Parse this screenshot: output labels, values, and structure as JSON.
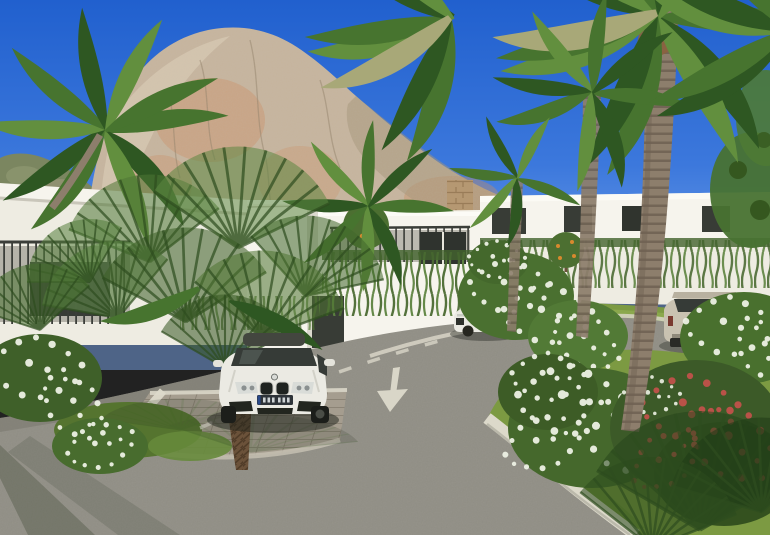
{
  "image_meta": {
    "kind": "photorealistic 3D architectural rendering",
    "subject": "modern white villa development at the foot of a large limestone rock, palm garden, curving asphalt road, white coupe parked on paver driveway",
    "contains_readable_text": false
  },
  "palette": {
    "sky_top": "#2160ce",
    "sky_mid": "#3c78dc",
    "sky_bottom": "#79a6ec",
    "rock_base": "#c6b49d",
    "rock_light": "#ddcfb8",
    "rock_orange": "#cb9168",
    "rock_shadow": "#a39378",
    "hill_green": "#7b8660",
    "building_white": "#f6f4ed",
    "building_face": "#eeece2",
    "building_shade": "#dcd9cf",
    "railing_dark": "#3b3e39",
    "window_dark": "#383c36",
    "vine_green": "#4c6b33",
    "grass_bright": "#7c9a42",
    "grass_dark": "#55742f",
    "frond_dark": "#2e5722",
    "frond_mid": "#47742f",
    "frond_light": "#628f3e",
    "trunk_brown": "#8d7e6c",
    "trunk_fiber": "#6b523a",
    "road_gray": "#8f8d84",
    "paver_tan": "#a59d8f",
    "line_white": "#d9d6c8",
    "curb_white": "#dcd9ca",
    "flower_white": "#edf1e4",
    "flower_red": "#c0524a",
    "orange_fruit": "#d8892e",
    "car_white": "#ebeae3",
    "car_glass": "#363b37",
    "suv_beige": "#c9c2b1"
  },
  "scene": {
    "sky": {
      "condition": "clear deep blue"
    },
    "mountain": {
      "type": "large limestone rock face with orange patches"
    },
    "left_hill": {
      "type": "green rocky hill"
    },
    "buildings": {
      "style": "modern flat-roof white villas",
      "features": [
        "dark metal railings",
        "hanging cascading plants on walls",
        "stone-clad accent pillar",
        "dark window openings"
      ]
    },
    "road": {
      "surface": "asphalt",
      "markings": [
        "white painted arrow pointing toward viewer",
        "dashed center line",
        "solid edge line",
        "white-edged paver parking bay"
      ],
      "curb": "white stone kerb along lawn"
    },
    "vehicles": {
      "foreground_car": {
        "type": "coupe",
        "color": "white",
        "brand_roundel_visible": true,
        "license_plate_visible": true,
        "license_plate_legible": false
      },
      "upper_driveway_car": {
        "type": "sedan",
        "color": "white"
      },
      "right_car": {
        "type": "suv",
        "color": "beige-silver"
      }
    },
    "vegetation": [
      "tall feather palms",
      "fan palms",
      "white oleander bushes",
      "red oleander bush",
      "orange trees with fruit",
      "bright lawn",
      "dark spiky grasses"
    ]
  }
}
